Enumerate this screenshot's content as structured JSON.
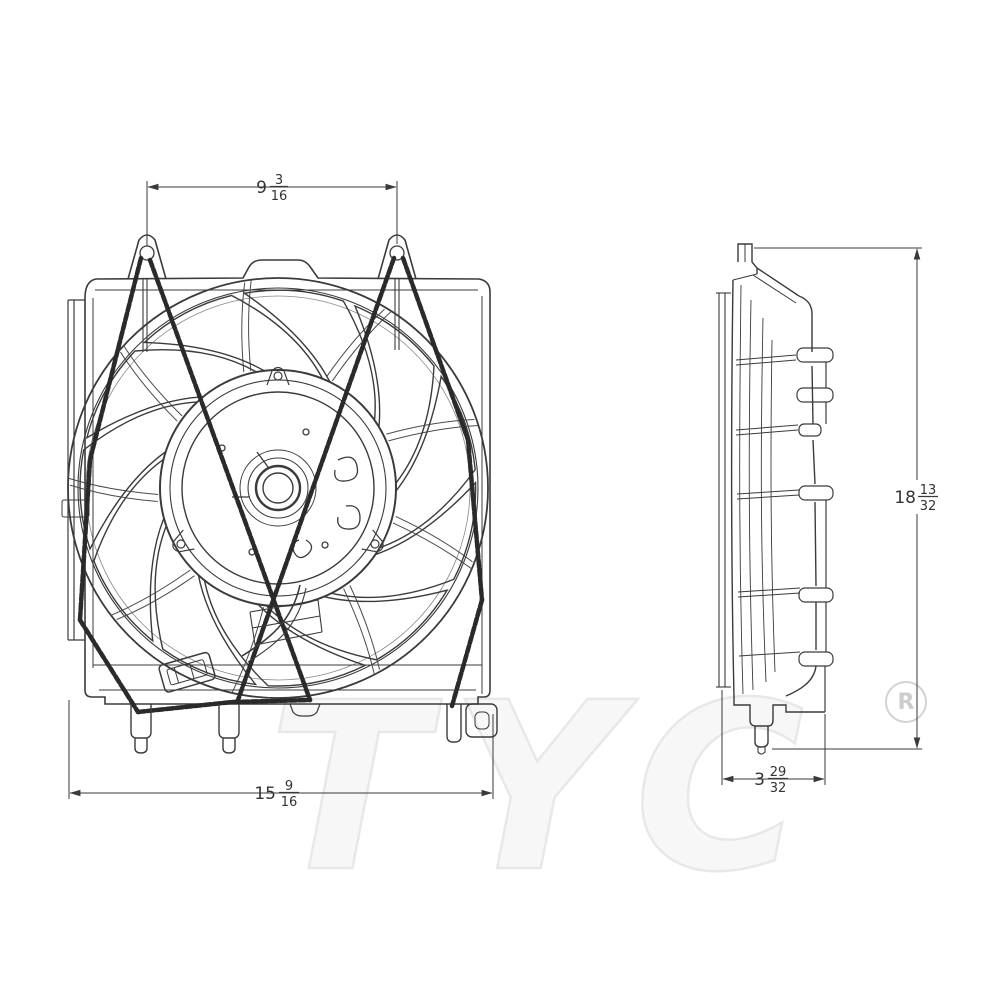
{
  "watermark": {
    "brand": "TYC",
    "registered_symbol": "R"
  },
  "dimensions": {
    "front_mount_hole_spacing": {
      "whole": "9",
      "numerator": "3",
      "denominator": "16"
    },
    "front_overall_width": {
      "whole": "15",
      "numerator": "9",
      "denominator": "16"
    },
    "overall_height": {
      "whole": "18",
      "numerator": "13",
      "denominator": "32"
    },
    "overall_depth": {
      "whole": "3",
      "numerator": "29",
      "denominator": "32"
    }
  },
  "drawing": {
    "subject": "radiator cooling fan assembly, front and side orthographic views",
    "units": "inches (fractional)"
  },
  "colors": {
    "line": "#3b3b3b",
    "dark_strut": "#2a2a2a",
    "dimension": "#3a3a3a",
    "watermark_fill": "#f7f7f7",
    "watermark_outline": "#e8e8e8",
    "registered_gray": "#cdcdcd",
    "background": "#ffffff"
  }
}
